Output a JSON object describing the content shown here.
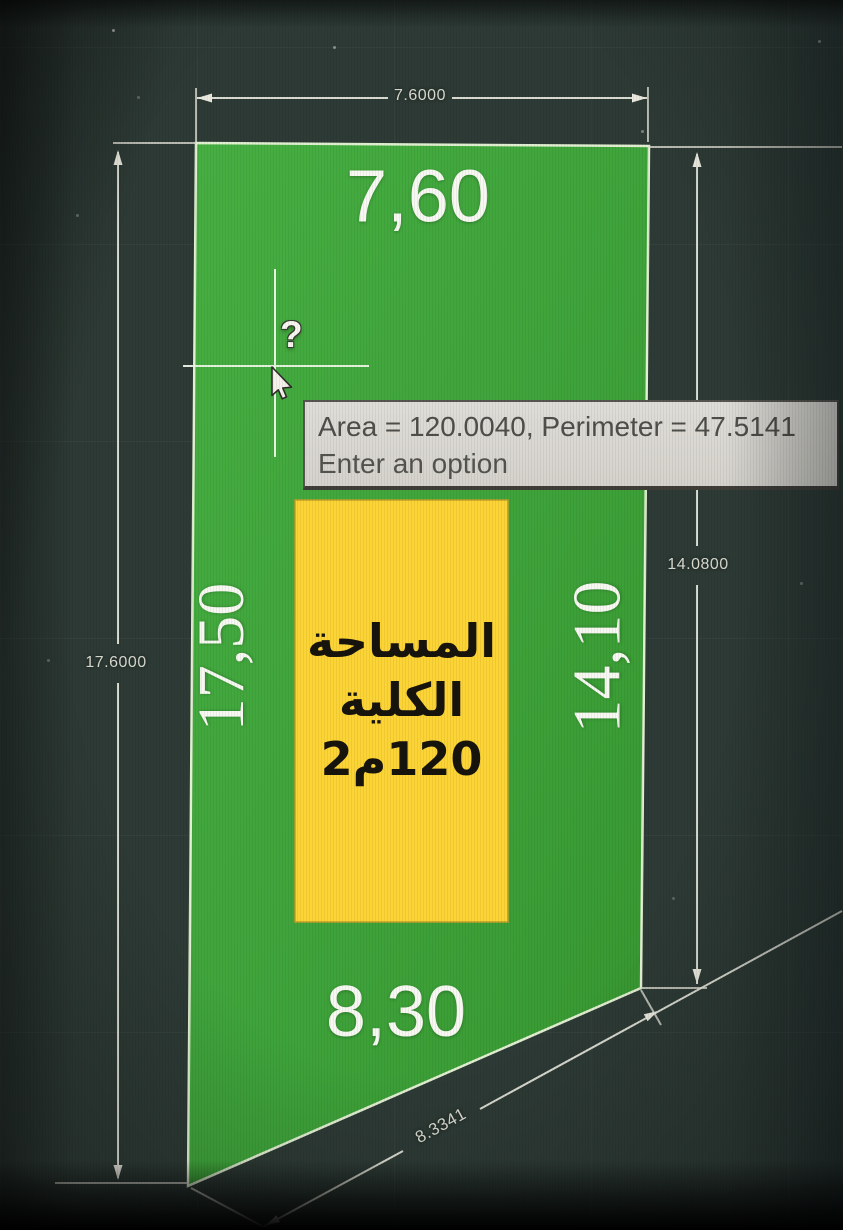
{
  "command_tooltip": {
    "line1": "Area = 120.0040, Perimeter = 47.5141",
    "line2": "Enter an option"
  },
  "plot_edge_labels": {
    "top": "7,60",
    "left": "17,50",
    "right": "14,10",
    "bottom": "8,30"
  },
  "area_box": {
    "line1": "المساحة",
    "line2": "الكلية",
    "line3": "120م2"
  },
  "dim_annotations": {
    "top": "7.6000",
    "left": "17.6000",
    "right": "14.0800",
    "bottom_slanted": "8.3341"
  },
  "cursor": {
    "badge": "?"
  },
  "colors": {
    "background": "#2d3a35",
    "plot_green": "#3ea43c",
    "area_yellow": "#fcd435",
    "dim_line": "#e0e0d6",
    "label_white": "#f8f8f2",
    "tooltip_bg": "#d9d7d1",
    "tooltip_text": "#4e4e4a"
  }
}
